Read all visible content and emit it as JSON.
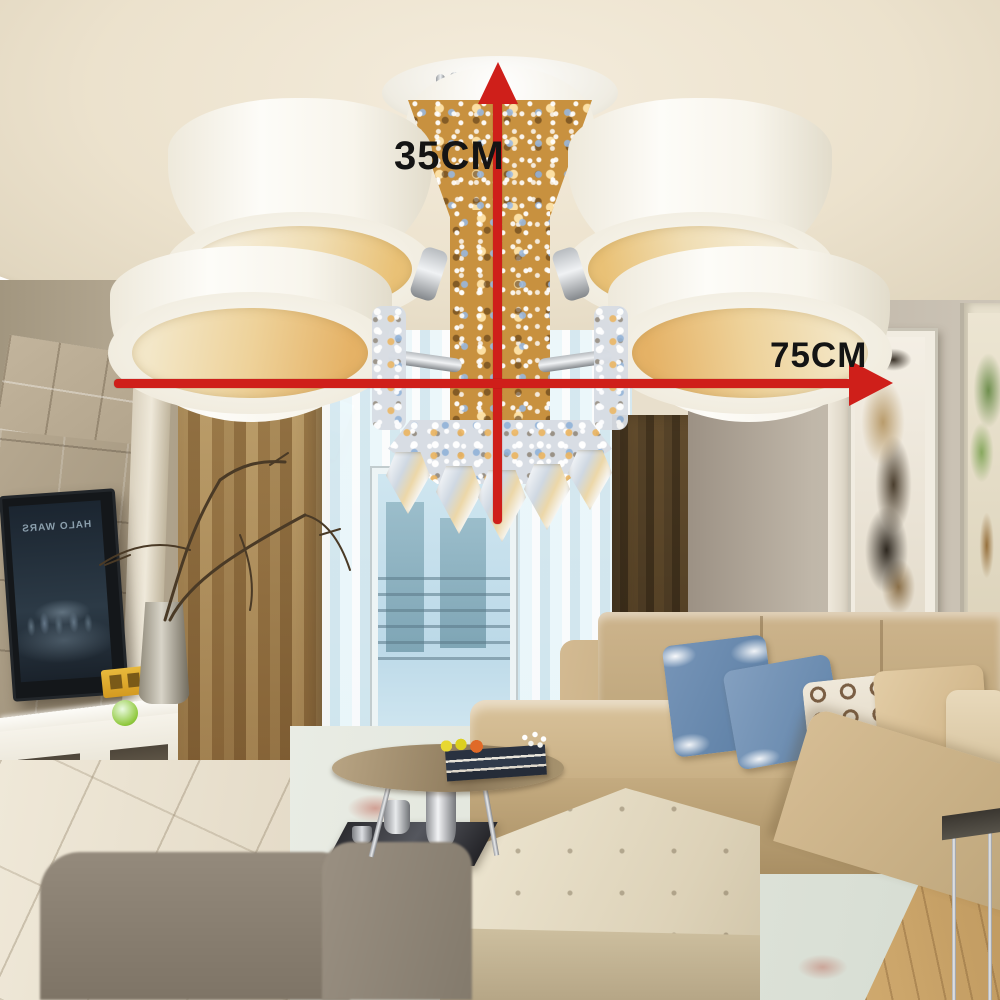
{
  "scene": {
    "description": "Living room product photo of a 5-light crystal ceiling chandelier with white drum shades",
    "annotations": {
      "height_label": "35CM",
      "width_label": "75CM",
      "arrow_color": "#cf1f1a",
      "label_color": "#141414"
    },
    "tv": {
      "screen_text": "HALO WARS"
    },
    "palette": {
      "ceiling": "#ece2cd",
      "curtain_tan": "#c7b28b",
      "sheer_blue": "#d7ecf4",
      "sofa_tan": "#cdb48c",
      "pillow_blue": "#5f82a8",
      "chandelier_gold": "#c8913f",
      "drum_white": "#f8f5ec",
      "lamp_glow": "#eed29a"
    }
  }
}
